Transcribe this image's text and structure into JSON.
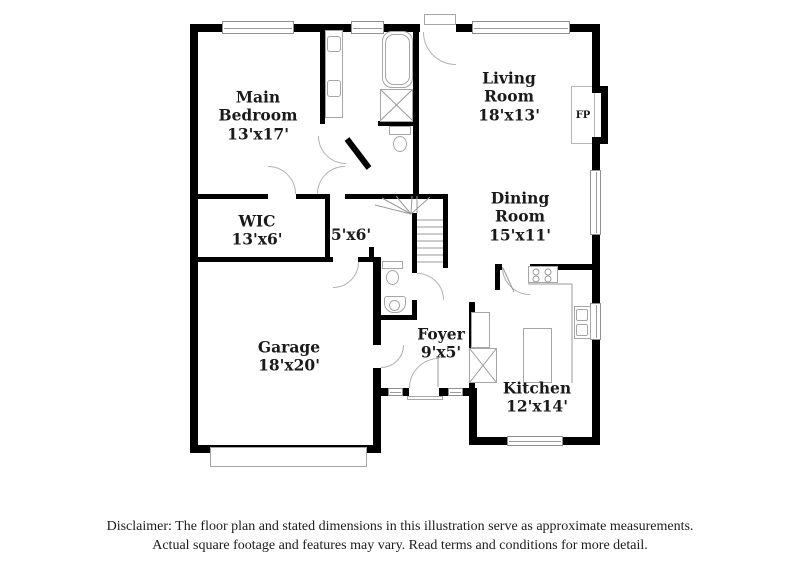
{
  "floor_plan": {
    "rooms": [
      {
        "id": "main-bedroom",
        "name": "Main Bedroom",
        "dims": "13'x17'"
      },
      {
        "id": "living-room",
        "name": "Living Room",
        "dims": "18'x13'"
      },
      {
        "id": "wic",
        "name": "WIC",
        "dims": "13'x6'"
      },
      {
        "id": "hall",
        "name": "",
        "dims": "5'x6'"
      },
      {
        "id": "dining-room",
        "name": "Dining Room",
        "dims": "15'x11'"
      },
      {
        "id": "garage",
        "name": "Garage",
        "dims": "18'x20'"
      },
      {
        "id": "foyer",
        "name": "Foyer",
        "dims": "9'x5'"
      },
      {
        "id": "kitchen",
        "name": "Kitchen",
        "dims": "12'x14'"
      }
    ],
    "fireplace_label": "FP"
  },
  "disclaimer": {
    "line1": "Disclaimer: The floor plan and stated dimensions in this illustration serve as approximate measurements.",
    "line2": "Actual square footage and features may vary. Read terms and conditions for more detail."
  },
  "colors": {
    "wall": "#000000",
    "fixture_outline": "#a6a6a6",
    "text": "#1a1a1a"
  }
}
